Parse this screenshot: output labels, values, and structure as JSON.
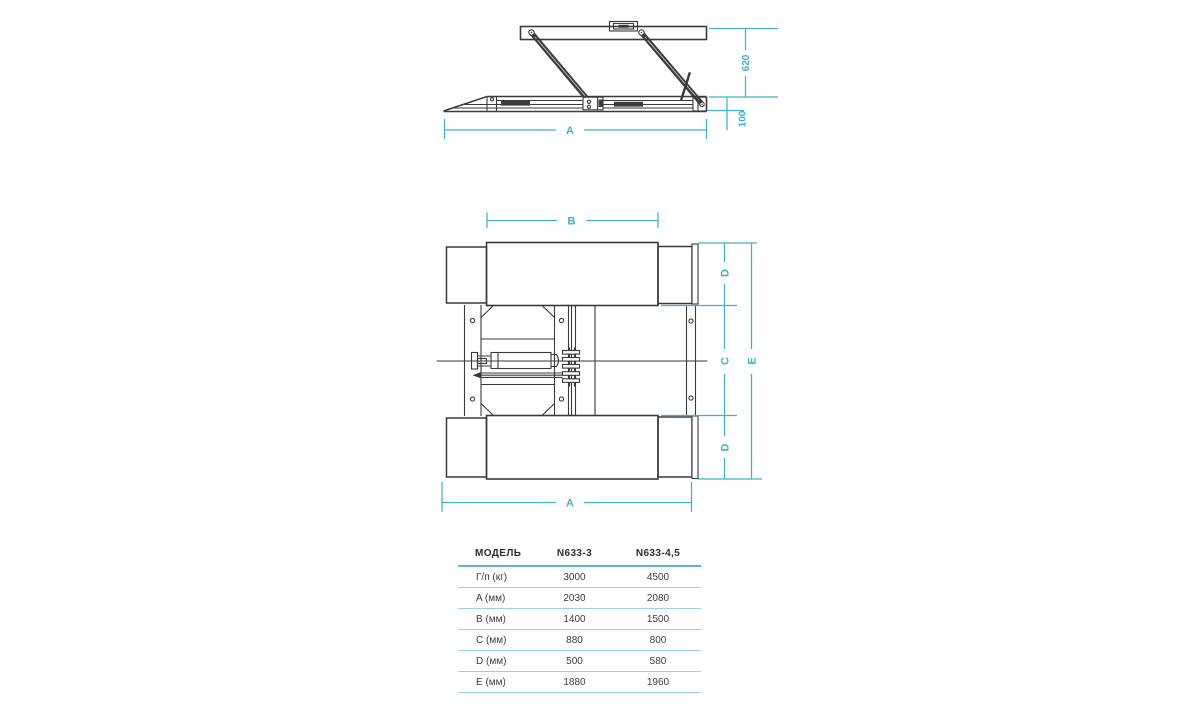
{
  "drawing": {
    "accent_color": "#3eb3c8",
    "line_color": "#3b3b3d",
    "side_view": {
      "labels": {
        "length_a": "A",
        "raised_height": "620",
        "base_height": "100"
      }
    },
    "top_view": {
      "labels": {
        "platform_b": "B",
        "length_a": "A",
        "center_c": "C",
        "ramp_d_top": "D",
        "ramp_d_bottom": "D",
        "overall_e": "E"
      }
    }
  },
  "spec_table": {
    "headers": [
      "МОДЕЛЬ",
      "N633-3",
      "N633-4,5"
    ],
    "rows": [
      {
        "label": "Г/п (кг)",
        "values": [
          "3000",
          "4500"
        ]
      },
      {
        "label": "A (мм)",
        "values": [
          "2030",
          "2080"
        ]
      },
      {
        "label": "B (мм)",
        "values": [
          "1400",
          "1500"
        ]
      },
      {
        "label": "C (мм)",
        "values": [
          "880",
          "800"
        ]
      },
      {
        "label": "D (мм)",
        "values": [
          "500",
          "580"
        ]
      },
      {
        "label": "E (мм)",
        "values": [
          "1880",
          "1960"
        ]
      }
    ]
  }
}
